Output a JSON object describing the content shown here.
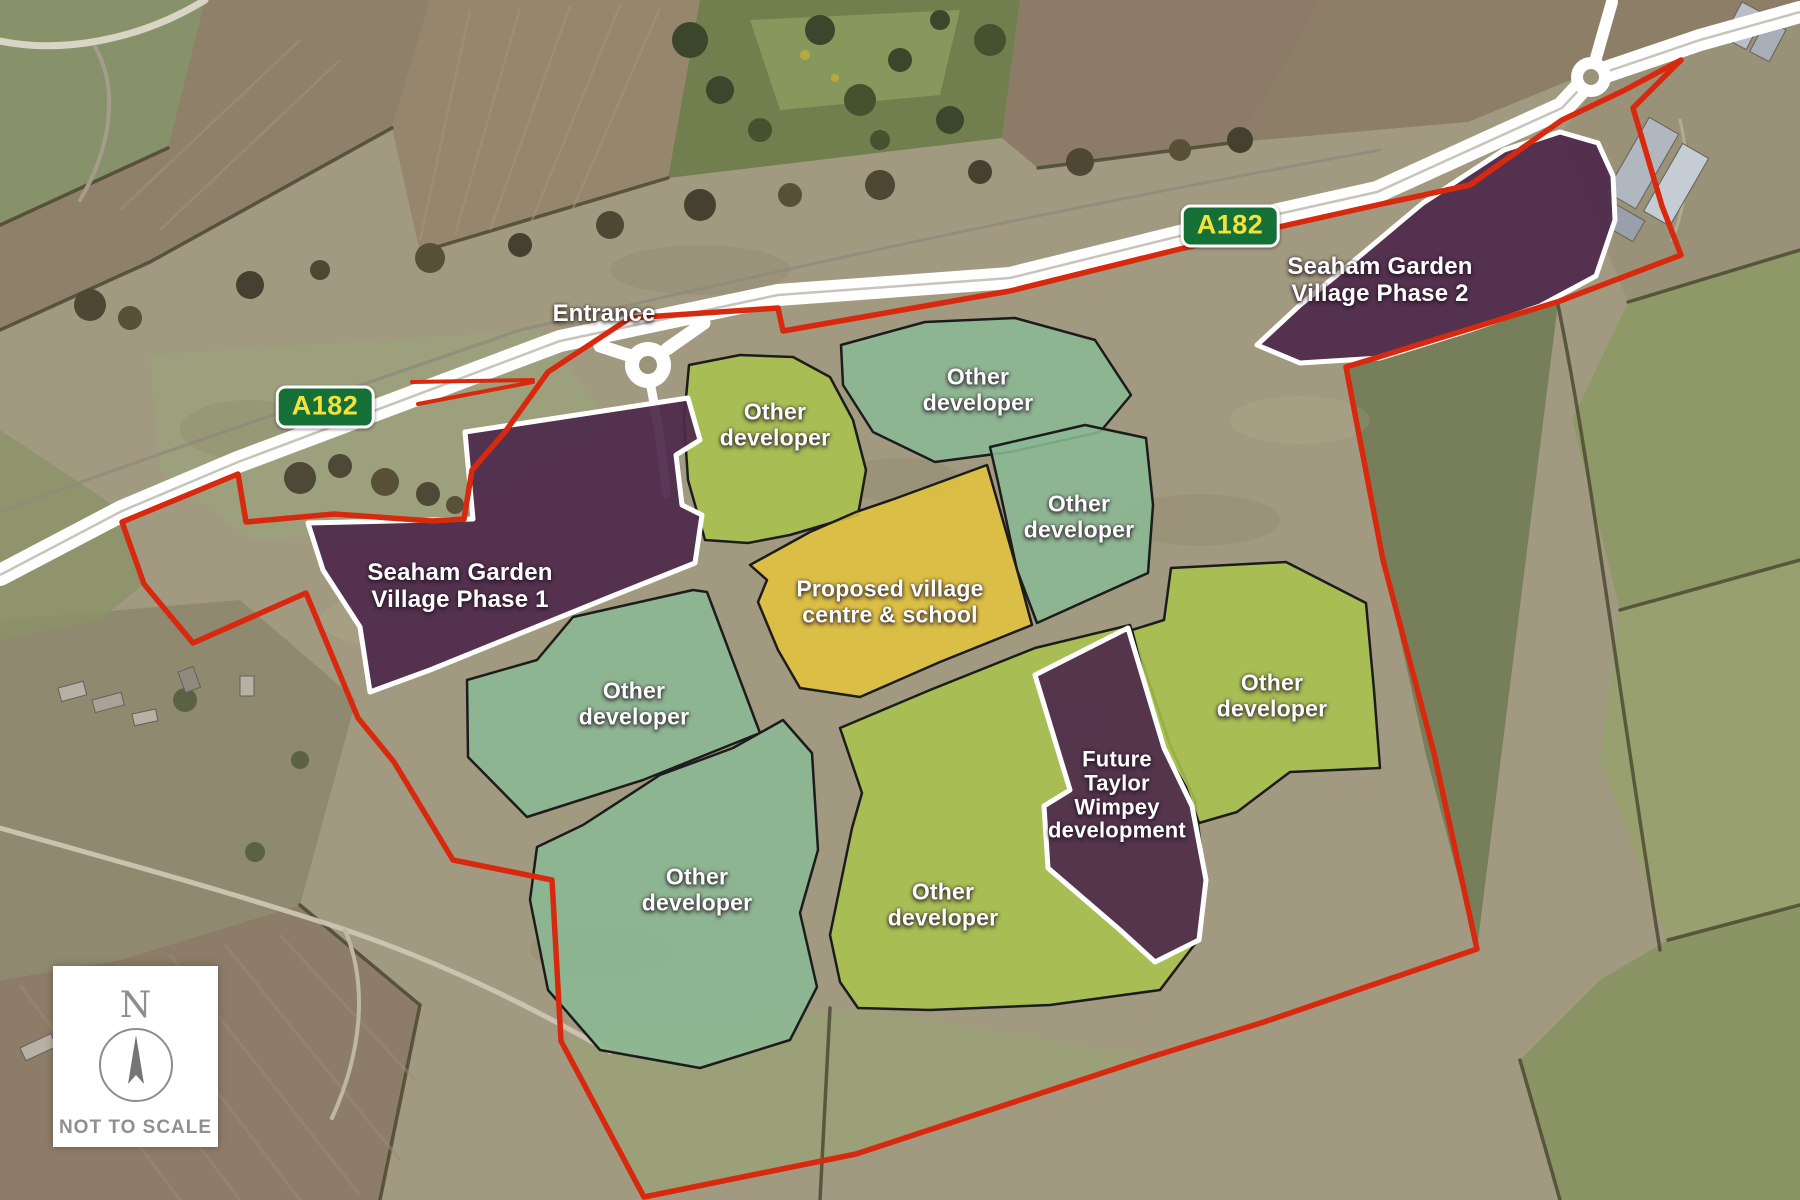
{
  "map": {
    "title": "Seaham Garden Village development site plan",
    "badges": [
      {
        "label": "A182"
      },
      {
        "label": "A182"
      }
    ],
    "entrance": {
      "label": "Entrance"
    },
    "zones": [
      {
        "id": "phase-1",
        "label": "Seaham Garden\nVillage Phase 1",
        "category": "phase"
      },
      {
        "id": "phase-2",
        "label": "Seaham Garden\nVillage Phase 2",
        "category": "phase"
      },
      {
        "id": "village-centre",
        "label": "Proposed village\ncentre & school",
        "category": "centre"
      },
      {
        "id": "taylor-wimpey",
        "label": "Future\nTaylor\nWimpey\ndevelopment",
        "category": "phase"
      },
      {
        "id": "other-developer-top-lime",
        "label": "Other\ndeveloper",
        "category": "other-lime"
      },
      {
        "id": "other-developer-top-sage",
        "label": "Other\ndeveloper",
        "category": "other-sage"
      },
      {
        "id": "other-developer-right-sage",
        "label": "Other\ndeveloper",
        "category": "other-sage"
      },
      {
        "id": "other-developer-middle-sage",
        "label": "Other\ndeveloper",
        "category": "other-sage"
      },
      {
        "id": "other-developer-bottom-sage",
        "label": "Other\ndeveloper",
        "category": "other-sage"
      },
      {
        "id": "other-developer-bottom-lime",
        "label": "Other\ndeveloper",
        "category": "other-lime"
      },
      {
        "id": "other-developer-right-lime",
        "label": "Other\ndeveloper",
        "category": "other-lime"
      }
    ],
    "compass": {
      "north": "N",
      "note": "NOT TO SCALE"
    },
    "colors": {
      "boundary_red": "#d8290e",
      "phase_purple": "#4e2a4b",
      "other_sage": "#8bb894",
      "other_lime": "#a9c24d",
      "village_centre_yellow": "#e2c33c",
      "badge_green": "#157037",
      "badge_text_yellow": "#f3e23c",
      "road_white": "#ffffff"
    }
  }
}
